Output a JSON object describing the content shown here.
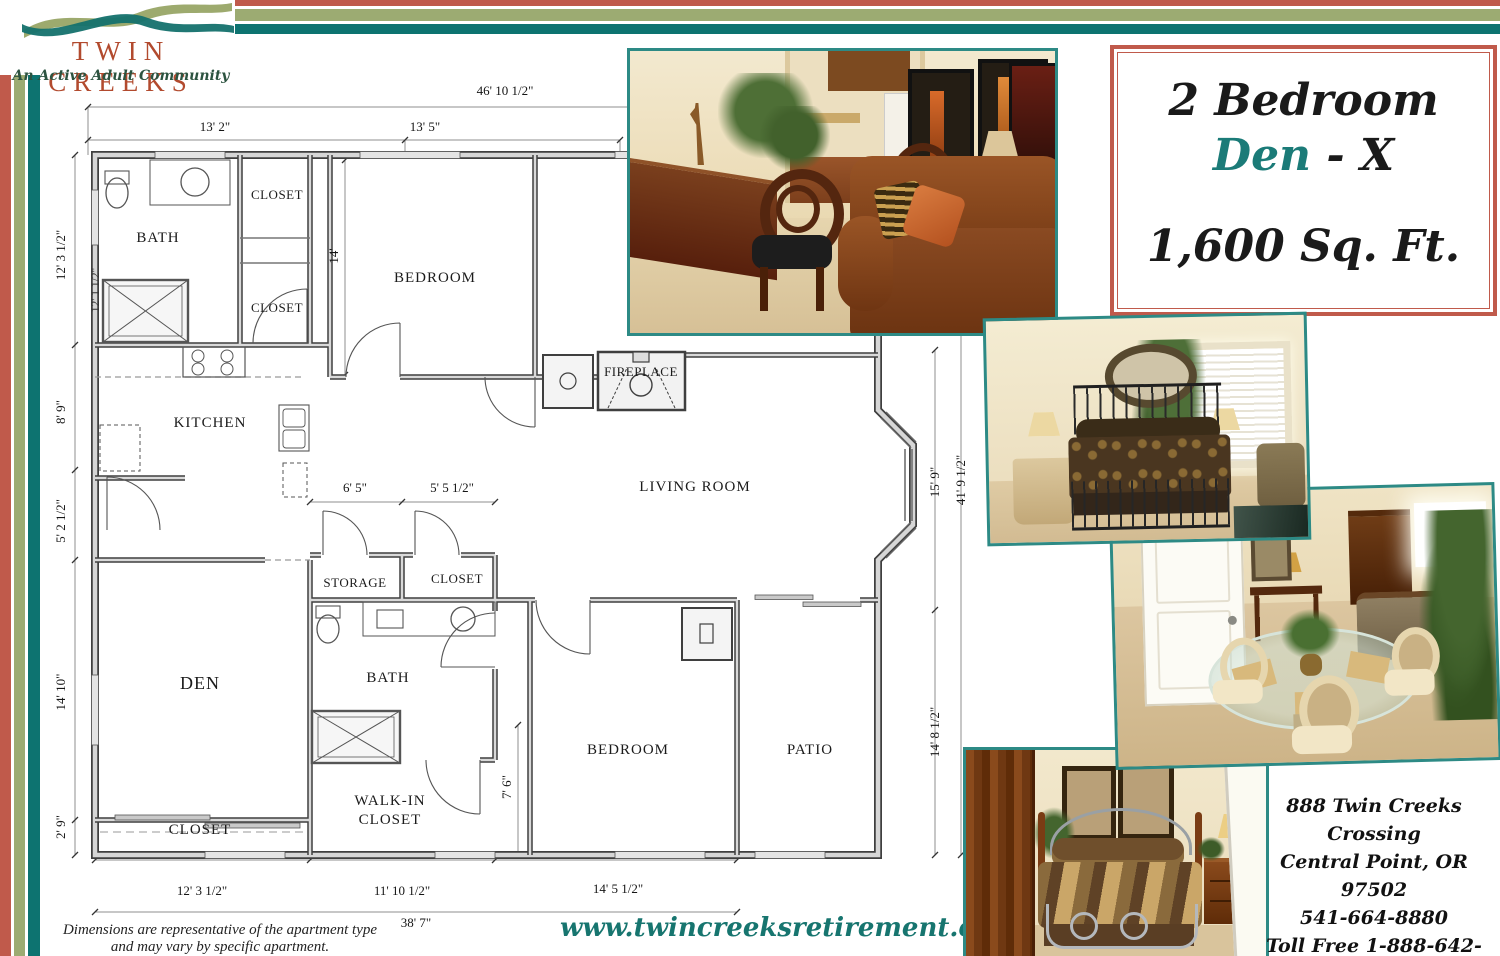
{
  "logo": {
    "name": "TWIN CREEKS",
    "tagline": "An Active Adult Community"
  },
  "title_box": {
    "line1": "2 Bedroom",
    "den": "Den",
    "den_suffix": " - X",
    "sqft": "1,600 Sq. Ft."
  },
  "plan": {
    "rooms": {
      "bath1": "BATH",
      "closet_top": "CLOSET",
      "closet_mid": "CLOSET",
      "bedroom1": "BEDROOM",
      "kitchen": "KITCHEN",
      "fireplace": "FIREPLACE",
      "living": "LIVING ROOM",
      "storage": "STORAGE",
      "closet_hall": "CLOSET",
      "bath2": "BATH",
      "den": "DEN",
      "walkin_line1": "WALK-IN",
      "walkin_line2": "CLOSET",
      "closet_den": "CLOSET",
      "bedroom2": "BEDROOM",
      "patio": "PATIO"
    },
    "dims": {
      "top_overall": "46' 10 1/2\"",
      "top_a": "13' 2\"",
      "top_b": "13' 5\"",
      "left_a": "12' 3 1/2\"",
      "left_a_inner": "12' 1 1/2\"",
      "left_b": "8' 9\"",
      "left_c": "5' 2 1/2\"",
      "left_d": "14' 10\"",
      "left_e": "2' 9\"",
      "mid_a": "6' 5\"",
      "mid_b": "5' 5 1/2\"",
      "bedroom1_side": "14'",
      "walkin_side": "7' 6\"",
      "right_a": "15' 9\"",
      "right_overall": "41' 9 1/2\"",
      "right_b": "14' 8 1/2\"",
      "bottom_a": "12' 3 1/2\"",
      "bottom_b": "11' 10 1/2\"",
      "bottom_c": "14' 5 1/2\"",
      "bottom_overall": "38' 7\""
    }
  },
  "photos": {
    "living": "Living room with writing desk, oval-back chairs and leather sofa",
    "master": "Master bedroom with iron bed and window",
    "dining": "Dining area with round glass table and cream chairs",
    "bedroom2": "Second bedroom with striped satin bedding"
  },
  "contact": {
    "line1": "888 Twin Creeks Crossing",
    "line2": "Central Point, OR  97502",
    "line3": "541-664-8880",
    "line4": "Toll Free  1-888-642-8880"
  },
  "website": "www.twincreeksretirement.com",
  "disclaimer": {
    "line1": "Dimensions are representative of the apartment type",
    "line2": "and may vary by specific apartment."
  },
  "colors": {
    "rust": "#c05a4b",
    "sage": "#9cab72",
    "teal": "#0d7370",
    "accent_teal": "#1b7b78",
    "logo_rust": "#b24a2e",
    "tagline_green": "#2c5340",
    "photo_border": "#2d8a85"
  }
}
